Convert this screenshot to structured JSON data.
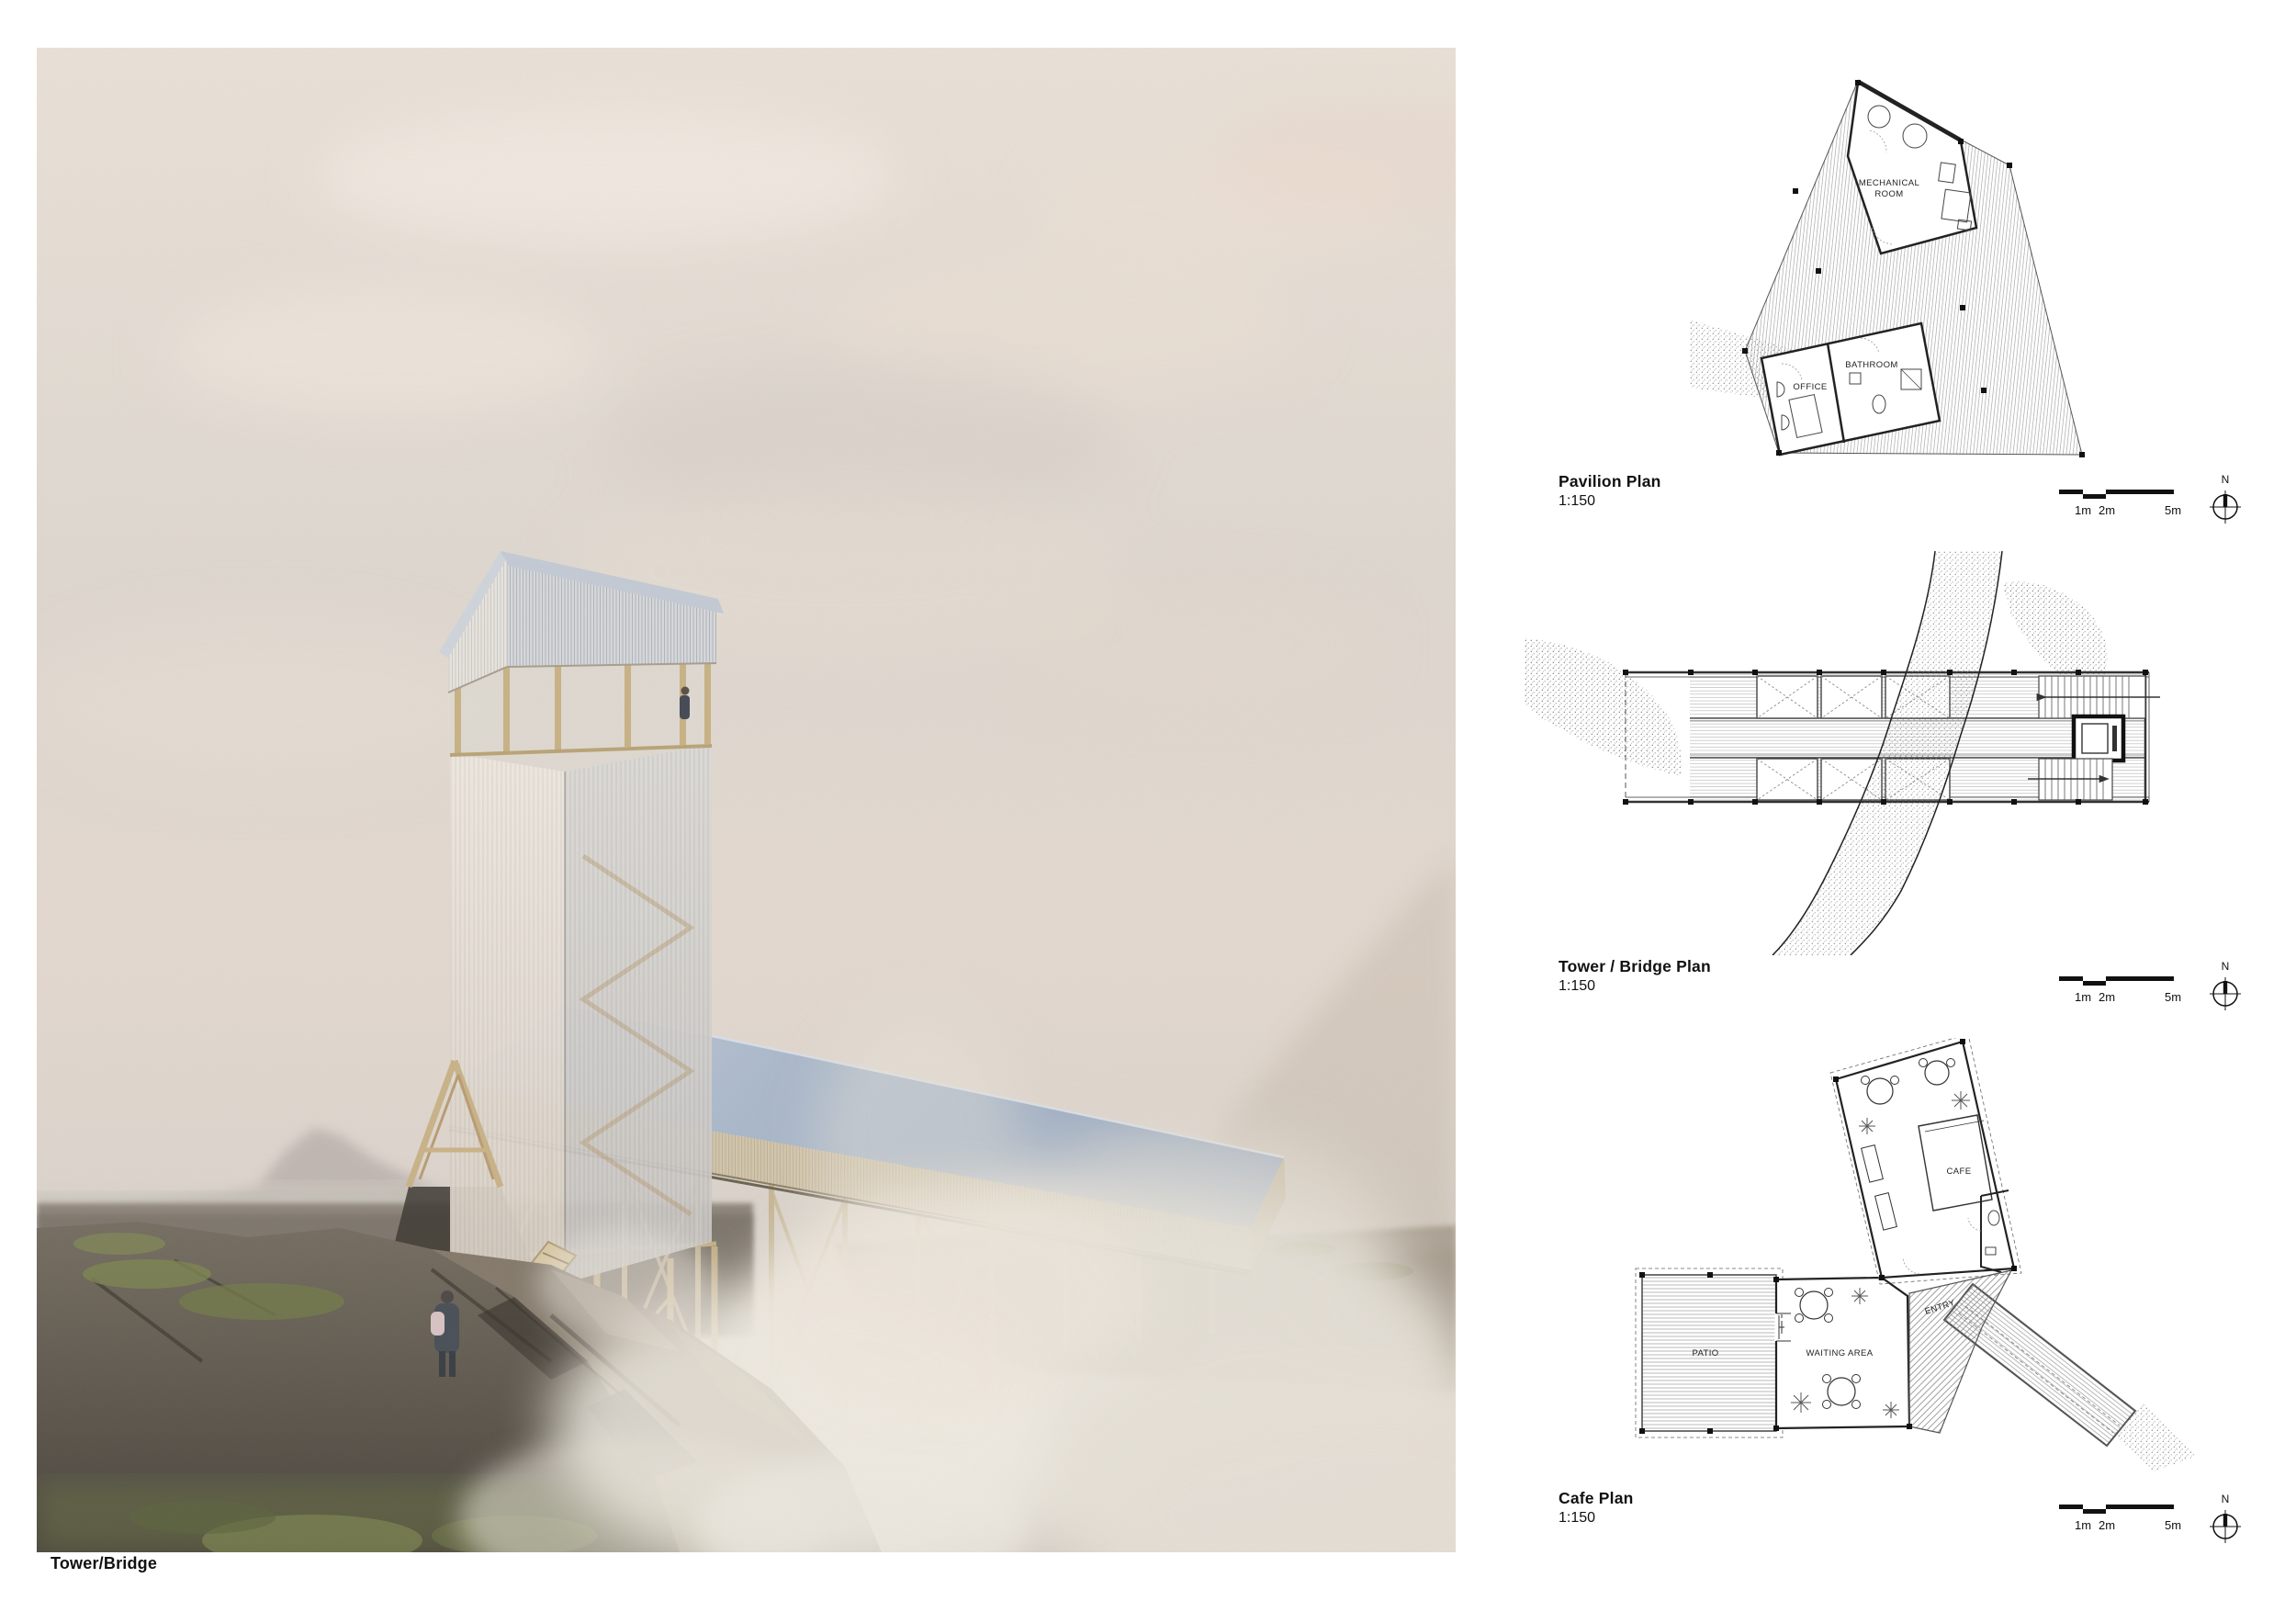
{
  "board": {
    "render_caption": "Tower/Bridge"
  },
  "plans": {
    "pavilion": {
      "title": "Pavilion Plan",
      "scale": "1:150",
      "rooms": {
        "mechanical_line1": "MECHANICAL",
        "mechanical_line2": "ROOM",
        "office": "OFFICE",
        "bathroom": "BATHROOM"
      }
    },
    "tower_bridge": {
      "title": "Tower / Bridge Plan",
      "scale": "1:150"
    },
    "cafe": {
      "title": "Cafe Plan",
      "scale": "1:150",
      "rooms": {
        "cafe": "CAFE",
        "patio": "PATIO",
        "waiting_area": "WAITING AREA",
        "entry": "ENTRY"
      }
    }
  },
  "scalebar": {
    "m1": "1m",
    "m2": "2m",
    "m5": "5m"
  },
  "compass": {
    "north": "N"
  },
  "colors": {
    "roof_blue": "#a9b6c8",
    "wood": "#cdbb94",
    "sky": "#e5ddd4",
    "rock": "#5b554c",
    "moss": "#7c8451",
    "steam": "#efeae1",
    "ink": "#1a1a1a"
  }
}
